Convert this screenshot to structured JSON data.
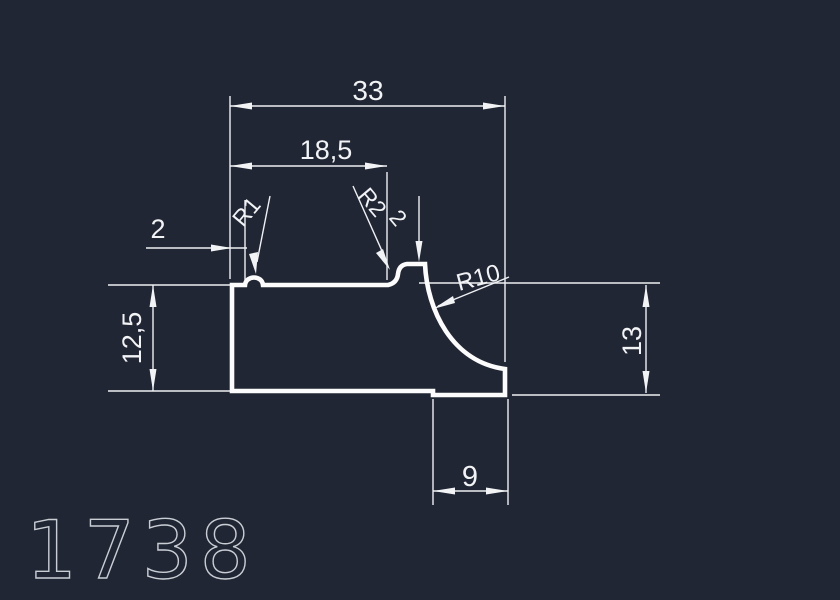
{
  "drawing": {
    "kind": "cad-profile-cross-section",
    "part_number": "1738",
    "colors": {
      "background": "#202633",
      "line": "#eef0f3",
      "profile_outline": "#fcfcfc",
      "part_number_text": "#c9cdd4"
    },
    "dimensions": {
      "overall_width": "33",
      "upper_step_width": "18,5",
      "left_notch_offset": "2",
      "notch_radius": "R1",
      "boss_fillet_radius": "R2",
      "boss_callout": "2",
      "cove_radius": "R10",
      "left_height": "12,5",
      "right_height": "13",
      "bottom_step_width": "9"
    }
  }
}
